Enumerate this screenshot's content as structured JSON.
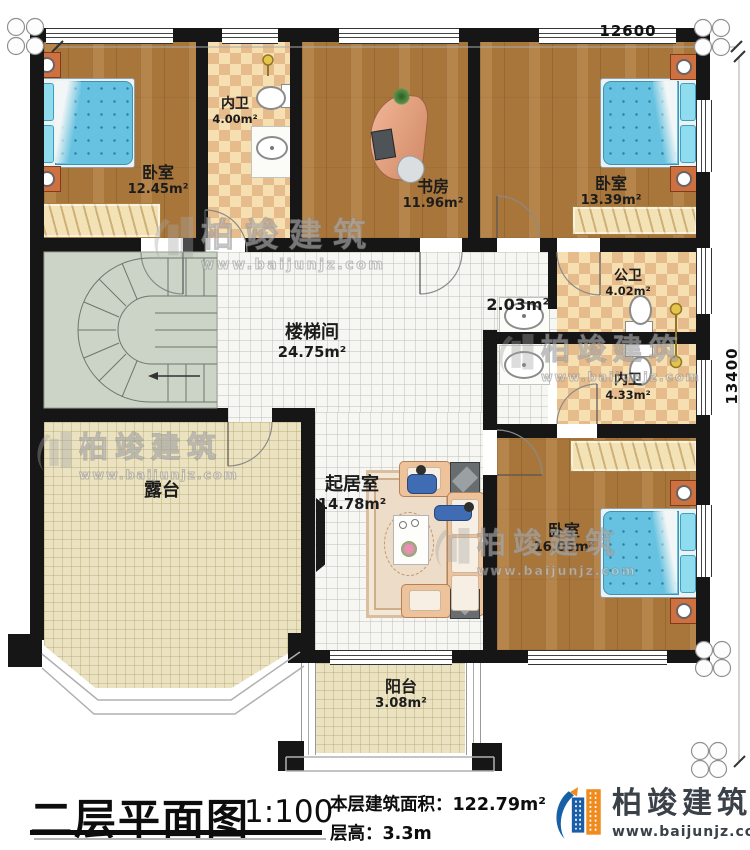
{
  "dimensions": {
    "top": "12600",
    "right": "13400"
  },
  "rooms": [
    {
      "name": "卧室",
      "area": "12.45m²"
    },
    {
      "name": "内卫",
      "area": "4.00m²"
    },
    {
      "name": "书房",
      "area": "11.96m²"
    },
    {
      "name": "卧室",
      "area": "13.39m²"
    },
    {
      "name": "楼梯间",
      "area": "24.75m²"
    },
    {
      "name": "",
      "area": "2.03m²"
    },
    {
      "name": "公卫",
      "area": "4.02m²"
    },
    {
      "name": "内卫",
      "area": "4.33m²"
    },
    {
      "name": "起居室",
      "area": "14.78m²"
    },
    {
      "name": "卧室",
      "area": "16.05m²"
    },
    {
      "name": "露台",
      "area": ""
    },
    {
      "name": "阳台",
      "area": "3.08m²"
    }
  ],
  "watermark": {
    "text": "柏竣建筑",
    "url": "www.baijunjz.com"
  },
  "footer": {
    "title": "二层平面图",
    "scale": "1:100",
    "area_label": "本层建筑面积：",
    "area_value": "122.79m²",
    "height_label": "层高：",
    "height_value": "3.3m"
  },
  "logo": {
    "text": "柏竣建筑",
    "url": "www.baijunjz.com"
  },
  "colors": {
    "wall": "#161616",
    "wood": "#b17c3e",
    "tile": "#f6e0b2",
    "logo_blue": "#1660a8",
    "logo_orange": "#f08c1e"
  }
}
